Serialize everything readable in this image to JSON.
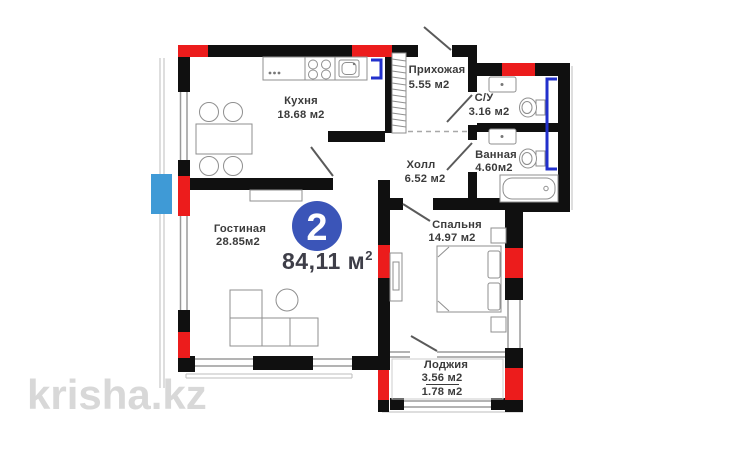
{
  "plan": {
    "badge": {
      "room_count": "2",
      "total_area": "84,11 м",
      "total_area_sup": "2"
    },
    "rooms": {
      "kitchen": {
        "name": "Кухня",
        "area": "18.68 м2"
      },
      "hallway": {
        "name": "Прихожая",
        "area": "5.55 м2"
      },
      "wc": {
        "name": "С/У",
        "area": "3.16 м2"
      },
      "bathroom": {
        "name": "Ванная",
        "area": "4.60м2"
      },
      "hall": {
        "name": "Холл",
        "area": "6.52 м2"
      },
      "bedroom": {
        "name": "Спальня",
        "area": "14.97 м2"
      },
      "living_room": {
        "name": "Гостиная",
        "area": "28.85м2"
      },
      "loggia": {
        "name": "Лоджия",
        "area_total": "3.56 м2",
        "area_half": "1.78 м2"
      }
    },
    "watermark": "krisha.kz",
    "colors": {
      "wall": "#101010",
      "radiator": "#ec1c1c",
      "plumbing_riser": "#2230cc",
      "ac_unit": "#3f9ad6",
      "badge": "#3b55b8",
      "label_text": "#3b3b3b",
      "watermark": "#d8d8d8"
    }
  }
}
